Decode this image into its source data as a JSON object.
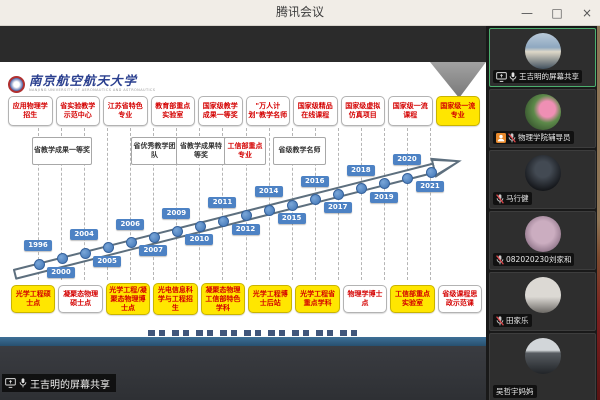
{
  "window": {
    "title": "腾讯会议",
    "controls": {
      "minimize": "—",
      "maximize": "□",
      "close": "×"
    }
  },
  "colors": {
    "timeline_blue": "#4d82c4",
    "highlight_yellow": "#ffe600",
    "achievement_red": "#d40000",
    "active_speaker_green": "#4caf6e"
  },
  "slide": {
    "university": {
      "name": "南京航空航天大学",
      "english": "NANJING UNIVERSITY OF AERONAUTICS AND ASTRONAUTICS"
    },
    "top_achievements": [
      {
        "label": "应用物理学招生",
        "highlight": false
      },
      {
        "label": "省实验教学示范中心",
        "highlight": false
      },
      {
        "label": "江苏省特色专业",
        "highlight": false
      },
      {
        "label": "教育部重点实验室",
        "highlight": false
      },
      {
        "label": "国家级教学成果一等奖",
        "highlight": false
      },
      {
        "label": "\"万人计划\"教学名师",
        "highlight": false
      },
      {
        "label": "国家级精品在线课程",
        "highlight": false
      },
      {
        "label": "国家级虚拟仿真项目",
        "highlight": false
      },
      {
        "label": "国家级一流课程",
        "highlight": false
      },
      {
        "label": "国家级一流专业",
        "highlight": true
      }
    ],
    "mid_achievements": [
      {
        "label": "省教学成果一等奖",
        "red": false
      },
      {
        "label": "省优秀教学团队",
        "red": false
      },
      {
        "label": "省教学成果特等奖",
        "red": false
      },
      {
        "label": "工信部重点专业",
        "red": true
      },
      {
        "label": "省级教学名师",
        "red": false
      }
    ],
    "timeline": {
      "years": [
        1996,
        2000,
        2004,
        2005,
        2006,
        2007,
        2009,
        2010,
        2011,
        2012,
        2014,
        2015,
        2016,
        2017,
        2018,
        2019,
        2020,
        2021
      ]
    },
    "bottom_achievements": [
      {
        "label": "光学工程硕士点",
        "highlight": true
      },
      {
        "label": "凝聚态物理硕士点",
        "highlight": false
      },
      {
        "label": "光学工程/凝聚态物理博士点",
        "highlight": true
      },
      {
        "label": "光电信息科学与工程招生",
        "highlight": true
      },
      {
        "label": "凝聚态物理工信部特色学科",
        "highlight": true
      },
      {
        "label": "光学工程博士后站",
        "highlight": true
      },
      {
        "label": "光学工程省重点学科",
        "highlight": true
      },
      {
        "label": "物理学博士点",
        "highlight": false
      },
      {
        "label": "工信部重点实验室",
        "highlight": true
      },
      {
        "label": "省级课程思政示范课",
        "highlight": false
      }
    ]
  },
  "share_badge": {
    "label": "王吉明的屏幕共享"
  },
  "participants": [
    {
      "name": "王吉明的屏幕共享",
      "avatar": "sky-landscape",
      "icons": [
        "screen-share",
        "mic-on"
      ],
      "active": true
    },
    {
      "name": "物理学院辅导员",
      "avatar": "lotus-flower",
      "icons": [
        "person-badge",
        "mic-muted"
      ],
      "active": false
    },
    {
      "name": "马行健",
      "avatar": "dark-photo",
      "icons": [
        "mic-muted"
      ],
      "active": false
    },
    {
      "name": "082020230刘家和",
      "avatar": "portrait-mauve",
      "icons": [
        "mic-muted"
      ],
      "active": false
    },
    {
      "name": "田家乐",
      "avatar": "portrait-light",
      "icons": [
        "mic-muted"
      ],
      "active": false
    },
    {
      "name": "吴哲宇妈妈",
      "avatar": "car-photo",
      "icons": [],
      "active": false
    }
  ]
}
